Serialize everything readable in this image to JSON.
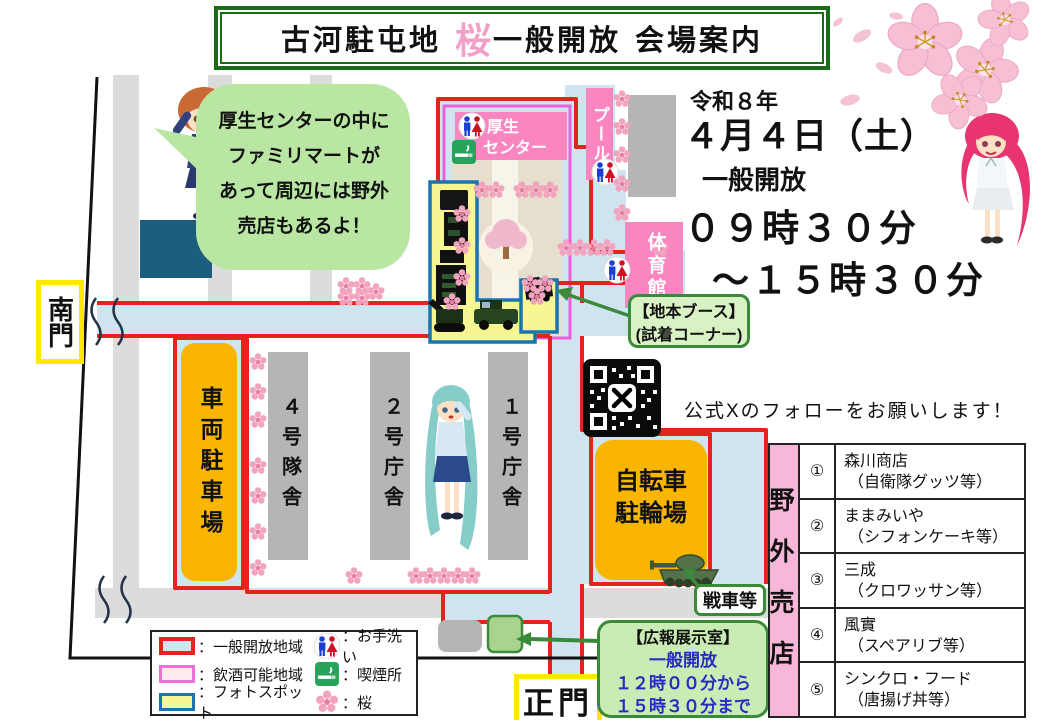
{
  "title": {
    "part1": "古河駐屯地",
    "sakura": "桜",
    "part2": "一般開放",
    "part3": "会場案内"
  },
  "event": {
    "era": "令和８年",
    "date": "４月４日（土）",
    "open_label": "一般開放",
    "time1": "０９時３０分",
    "time2": "～１５時３０分"
  },
  "speech_bubble": {
    "lines": [
      "厚生センターの中に",
      "ファミリマートが",
      "あって周辺には野外",
      "売店もあるよ！"
    ]
  },
  "map": {
    "south_gate": "南門",
    "main_gate": "正門",
    "welfare_center": {
      "line1": "厚生",
      "line2": "センター"
    },
    "pool": "プール",
    "gym": "体育館",
    "vehicle_parking": "車両駐車場",
    "bldg4": "４号隊舎",
    "bldg2": "２号庁舎",
    "bldg1": "１号庁舎",
    "bicycle": {
      "line1": "自転車",
      "line2": "駐輪場"
    }
  },
  "callouts": {
    "booth": {
      "line1": "【地本ブース】",
      "line2": "(試着コーナー)"
    },
    "tank": "戦車等",
    "pr_room": {
      "title": "【広報展示室】",
      "lines": [
        "一般開放",
        "１２時００分から",
        "１５時３０分まで"
      ]
    }
  },
  "qr": {
    "caption": "公式Xのフォローをお願いします！"
  },
  "legend": {
    "areas": [
      {
        "label": "：一般開放地域"
      },
      {
        "label": "：飲酒可能地域"
      },
      {
        "label": "：フォトスポット"
      }
    ],
    "marks": [
      {
        "label": "：お手洗い"
      },
      {
        "label": "：喫煙所"
      },
      {
        "label": "：桜"
      }
    ]
  },
  "shops": {
    "header": "野外売店",
    "rows": [
      {
        "no": "①",
        "name": "森川商店",
        "desc": "（自衛隊グッツ等）"
      },
      {
        "no": "②",
        "name": "ままみいや",
        "desc": "（シフォンケーキ等）"
      },
      {
        "no": "③",
        "name": "三成",
        "desc": "（クロワッサン等）"
      },
      {
        "no": "④",
        "name": "風實",
        "desc": "（スペアリブ等）"
      },
      {
        "no": "⑤",
        "name": "シンクロ・フード",
        "desc": "（唐揚げ丼等）"
      }
    ]
  },
  "colors": {
    "open_area": "#cfe4ef",
    "drink_area_border": "#ec5fd8",
    "photo_spot": "#f6f693",
    "route_red": "#e3241d",
    "callout_green": "#3a8a3a",
    "building_pink": "#f985c1",
    "parking_orange": "#f9b500",
    "table_pink": "#f8b7d9",
    "sakura_pink": "#f2a0c8"
  }
}
